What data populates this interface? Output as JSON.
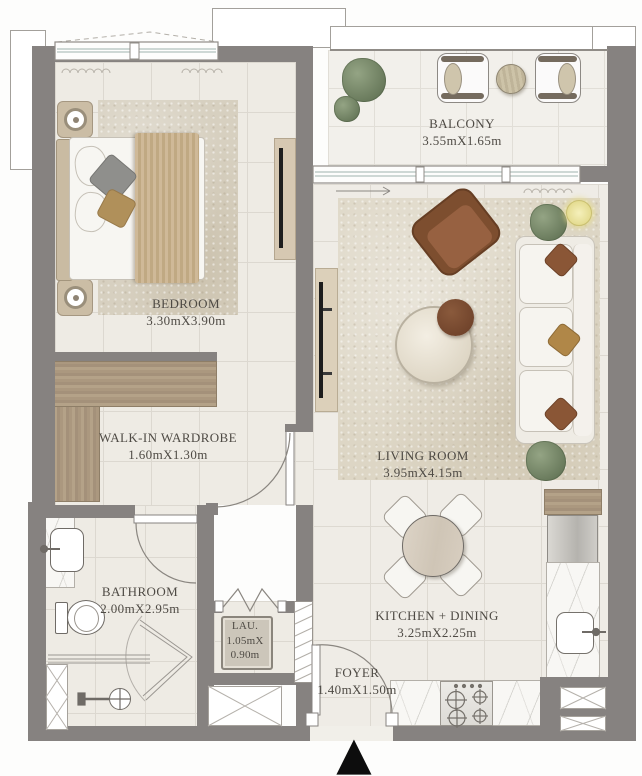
{
  "rooms": [
    {
      "name": "bedroom",
      "label": "BEDROOM",
      "dimensions": "3.30mX3.90m"
    },
    {
      "name": "walk-in-wardrobe",
      "label": "WALK-IN WARDROBE",
      "dimensions": "1.60mX1.30m"
    },
    {
      "name": "bathroom",
      "label": "BATHROOM",
      "dimensions": "2.00mX2.95m"
    },
    {
      "name": "laundry",
      "label": "LAU.",
      "dimensions_line1": "1.05mX",
      "dimensions_line2": "0.90m"
    },
    {
      "name": "foyer",
      "label": "FOYER",
      "dimensions": "1.40mX1.50m"
    },
    {
      "name": "kitchen-dining",
      "label": "KITCHEN + DINING",
      "dimensions": "3.25mX2.25m"
    },
    {
      "name": "living-room",
      "label": "LIVING ROOM",
      "dimensions": "3.95mX4.15m"
    },
    {
      "name": "balcony",
      "label": "BALCONY",
      "dimensions": "3.55mX1.65m"
    }
  ],
  "icons": {
    "entrance_marker": "▲"
  },
  "colors": {
    "wall": "#868280",
    "floor": "#eeebe4",
    "tile_line": "#dcd8d0",
    "wood": "#ab987f",
    "rug": "#d7d0c0",
    "sofa": "#f2efe9",
    "armchair": "#8a5433",
    "pouf": "#7b4c31",
    "marble": "#f8f7f4",
    "plant": "#7f8f6f",
    "lamp": "#ece5a0",
    "label_text": "#4e4a44",
    "entrance_marker": "#0d0d0d"
  }
}
